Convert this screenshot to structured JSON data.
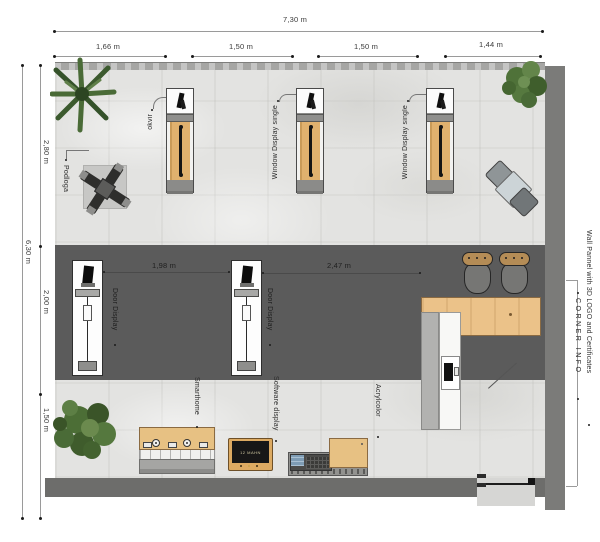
{
  "plan": {
    "dims_top": {
      "overall": "7,30 m",
      "seg1": "1,66 m",
      "seg2": "1,50 m",
      "seg3": "1,50 m",
      "seg4": "1,44 m"
    },
    "dims_left": {
      "overall": "6,30 m",
      "seg1": "2,80 m",
      "seg2": "2,00 m",
      "seg3": "1,50 m"
    },
    "dims_mid": {
      "d1": "1,98 m",
      "d2": "2,47 m"
    },
    "annotations": {
      "okvir": "okvir",
      "podloga": "Podloga",
      "window_display_a": "Window Display single",
      "window_display_b": "Window Display single",
      "door_display_a": "Door Display",
      "door_display_b": "Door Display",
      "smarthome": "Smarthome",
      "software_display": "Software display",
      "acrylcolor": "Acrylcolor",
      "wall_pannel": "Wall Pannel with 3D LOGO and Certificates",
      "corner_info": "CORNER INFO"
    },
    "tv_screen_text": "12 MAHN",
    "colors": {
      "floor_light": "#e3e3e1",
      "floor_dark": "#5b5b5b",
      "wall_gray": "#7b7b79",
      "counter_wood": "#ebc289",
      "display_wood": "#e0b16e",
      "plant_green": "#4c6e36",
      "annotation_text": "#3a3a3a"
    }
  }
}
